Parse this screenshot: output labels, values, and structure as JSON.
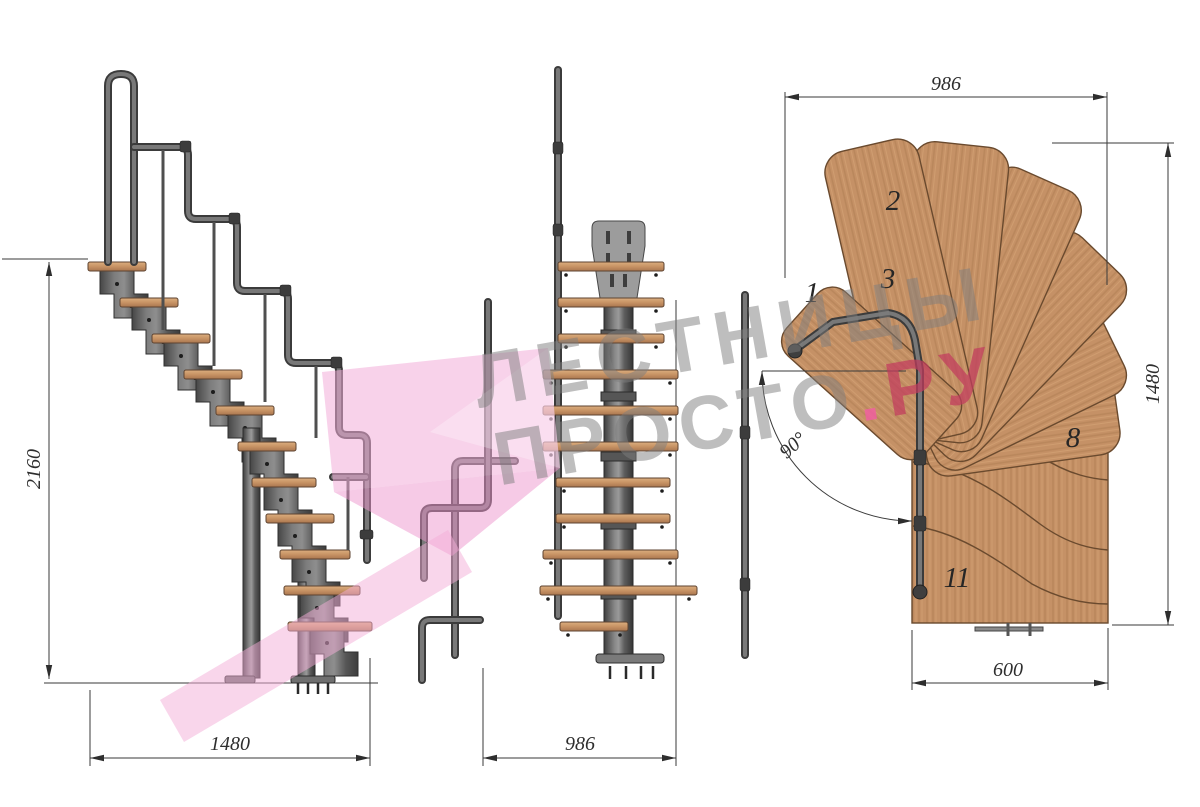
{
  "drawing": {
    "side_view": {
      "height_label": "2160",
      "width_label": "1480"
    },
    "front_view": {
      "width_label": "986"
    },
    "plan_view": {
      "width_label": "986",
      "depth_label": "1480",
      "flight_width_label": "600",
      "angle_label": "90°",
      "step_numbers": [
        "1",
        "2",
        "3",
        "8",
        "11"
      ]
    },
    "watermark": {
      "line1": "ЛЕСТНИЦЫ",
      "line2_main": "ПРОСТО",
      "line2_dot": ".",
      "line2_tld": "РУ"
    },
    "colors": {
      "background": "#ffffff",
      "wood": "#c59166",
      "wood_grain": "#ab7a4e",
      "wood_outline": "#6a4a2e",
      "metal": "#5f5f5f",
      "metal_dark": "#3c3c3c",
      "steel_light": "#9c9c9c",
      "pink_logo": "#f3addb",
      "watermark_gray": "#7d7d7d",
      "brand_red": "#c23b5e",
      "brand_dot_pink": "#ee5f9f",
      "dim_line": "#3a3a3a"
    }
  }
}
